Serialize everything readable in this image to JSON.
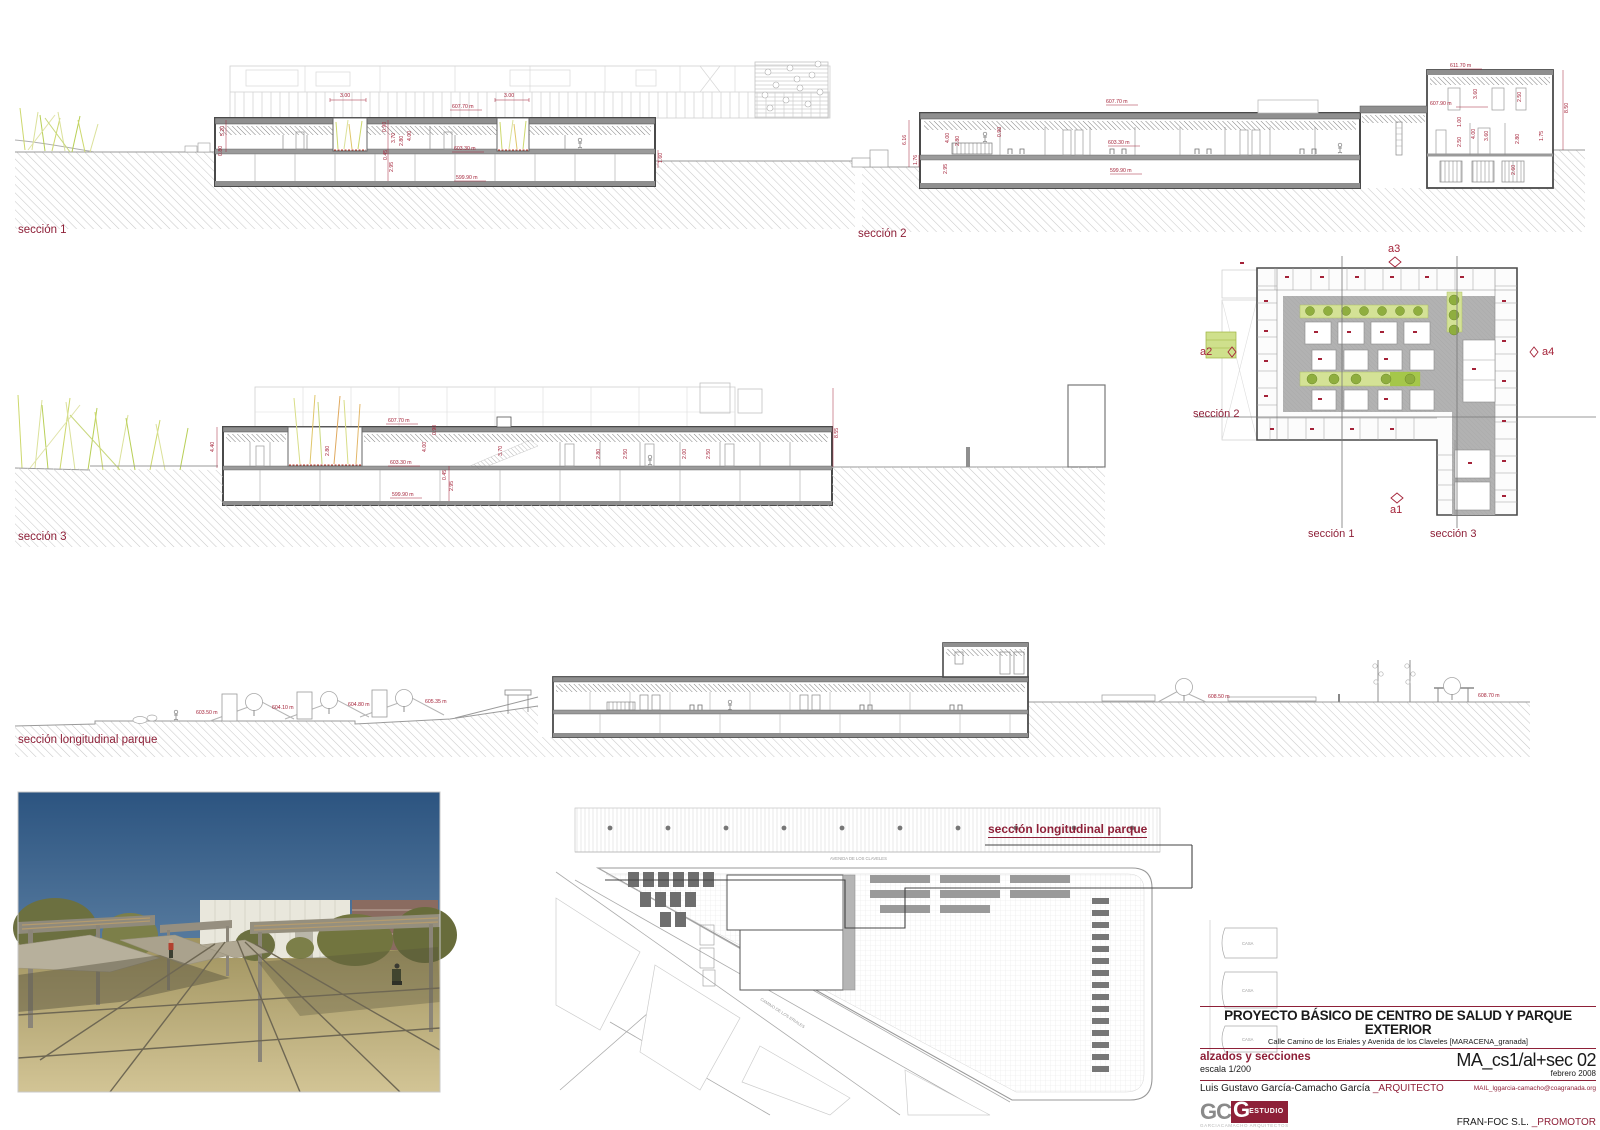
{
  "colors": {
    "accent": "#8e2038",
    "annotation": "#a42238",
    "reed_green": "#ccd96b",
    "tree_green": "#8fae3f",
    "strip_green": "#d4e296"
  },
  "labels": {
    "seccion1": "sección 1",
    "seccion2": "sección 2",
    "seccion3": "sección 3",
    "seccion_long": "sección longitudinal parque"
  },
  "s1": {
    "levels": {
      "roof": "607.70 m",
      "floor": "603.30 m",
      "base": "599.90 m"
    },
    "dims": {
      "a": "3.00",
      "b": "3.00",
      "c": "5.20",
      "d": "0.80",
      "e": "0.90",
      "f": "3.70",
      "g": "2.80",
      "h": "4.00",
      "i": "0.45",
      "j": "2.95",
      "k": "1.60"
    }
  },
  "s2": {
    "levels": {
      "tower": "611.70 m",
      "roof": "607.70 m",
      "upper": "607.90 m",
      "floor": "603.30 m",
      "base": "599.90 m"
    },
    "dims": {
      "a": "6.16",
      "b": "1.76",
      "c": "2.95",
      "d": "4.00",
      "e": "2.80",
      "f": "0.90",
      "g": "3.60",
      "h": "2.50",
      "i": "1.00",
      "j": "4.00",
      "k": "3.60",
      "l": "2.80",
      "m": "1.75",
      "n": "2.50",
      "o": "2.60",
      "p": "8.50"
    }
  },
  "s3": {
    "levels": {
      "roof": "607.70 m",
      "floor": "603.30 m",
      "base": "599.90 m"
    },
    "dims": {
      "a": "4.40",
      "b": "2.80",
      "c": "0.90",
      "d": "4.00",
      "e": "0.45",
      "f": "2.95",
      "g": "3.70",
      "h": "2.80",
      "i": "2.50",
      "j": "2.00",
      "k": "2.50",
      "l": "8.55"
    }
  },
  "slong": {
    "levels": [
      "603.50 m",
      "604.10 m",
      "604.80 m",
      "605.35 m",
      "608.50 m",
      "608.70 m"
    ]
  },
  "plan": {
    "a1": "a1",
    "a2": "a2",
    "a3": "a3",
    "a4": "a4",
    "cut1": "sección 1",
    "cut2": "sección 2",
    "cut3": "sección 3"
  },
  "site": {
    "cut_label": "sección longitudinal parque",
    "street_top": "AVENIDA DE LOS CLAVELES",
    "street_diag": "CAMINO DE LOS ERIALES",
    "house1": "CASA",
    "house2": "CASA",
    "house3": "CASA"
  },
  "title_block": {
    "title": "PROYECTO BÁSICO  DE CENTRO DE SALUD Y PARQUE EXTERIOR",
    "subtitle": "Calle Camino de los Eriales y Avenida de los Claveles [MARACENA_granada]",
    "doc_type": "alzados y secciones",
    "scale": "escala 1/200",
    "code": "MA_cs1/al+sec 02",
    "date": "febrero 2008",
    "architect": "Luis Gustavo García-Camacho García",
    "architect_role": "_ARQUITECTO",
    "mail": "MAIL_lggarcia-camacho@coagranada.org",
    "logo_gc": "GC",
    "logo_g": "G",
    "logo_estudio": "ESTUDIO",
    "logo_sub": "GARCIACAMACHO ARQUITECTOS",
    "promoter": "FRAN-FOC S.L.",
    "promoter_role": "_PROMOTOR"
  }
}
